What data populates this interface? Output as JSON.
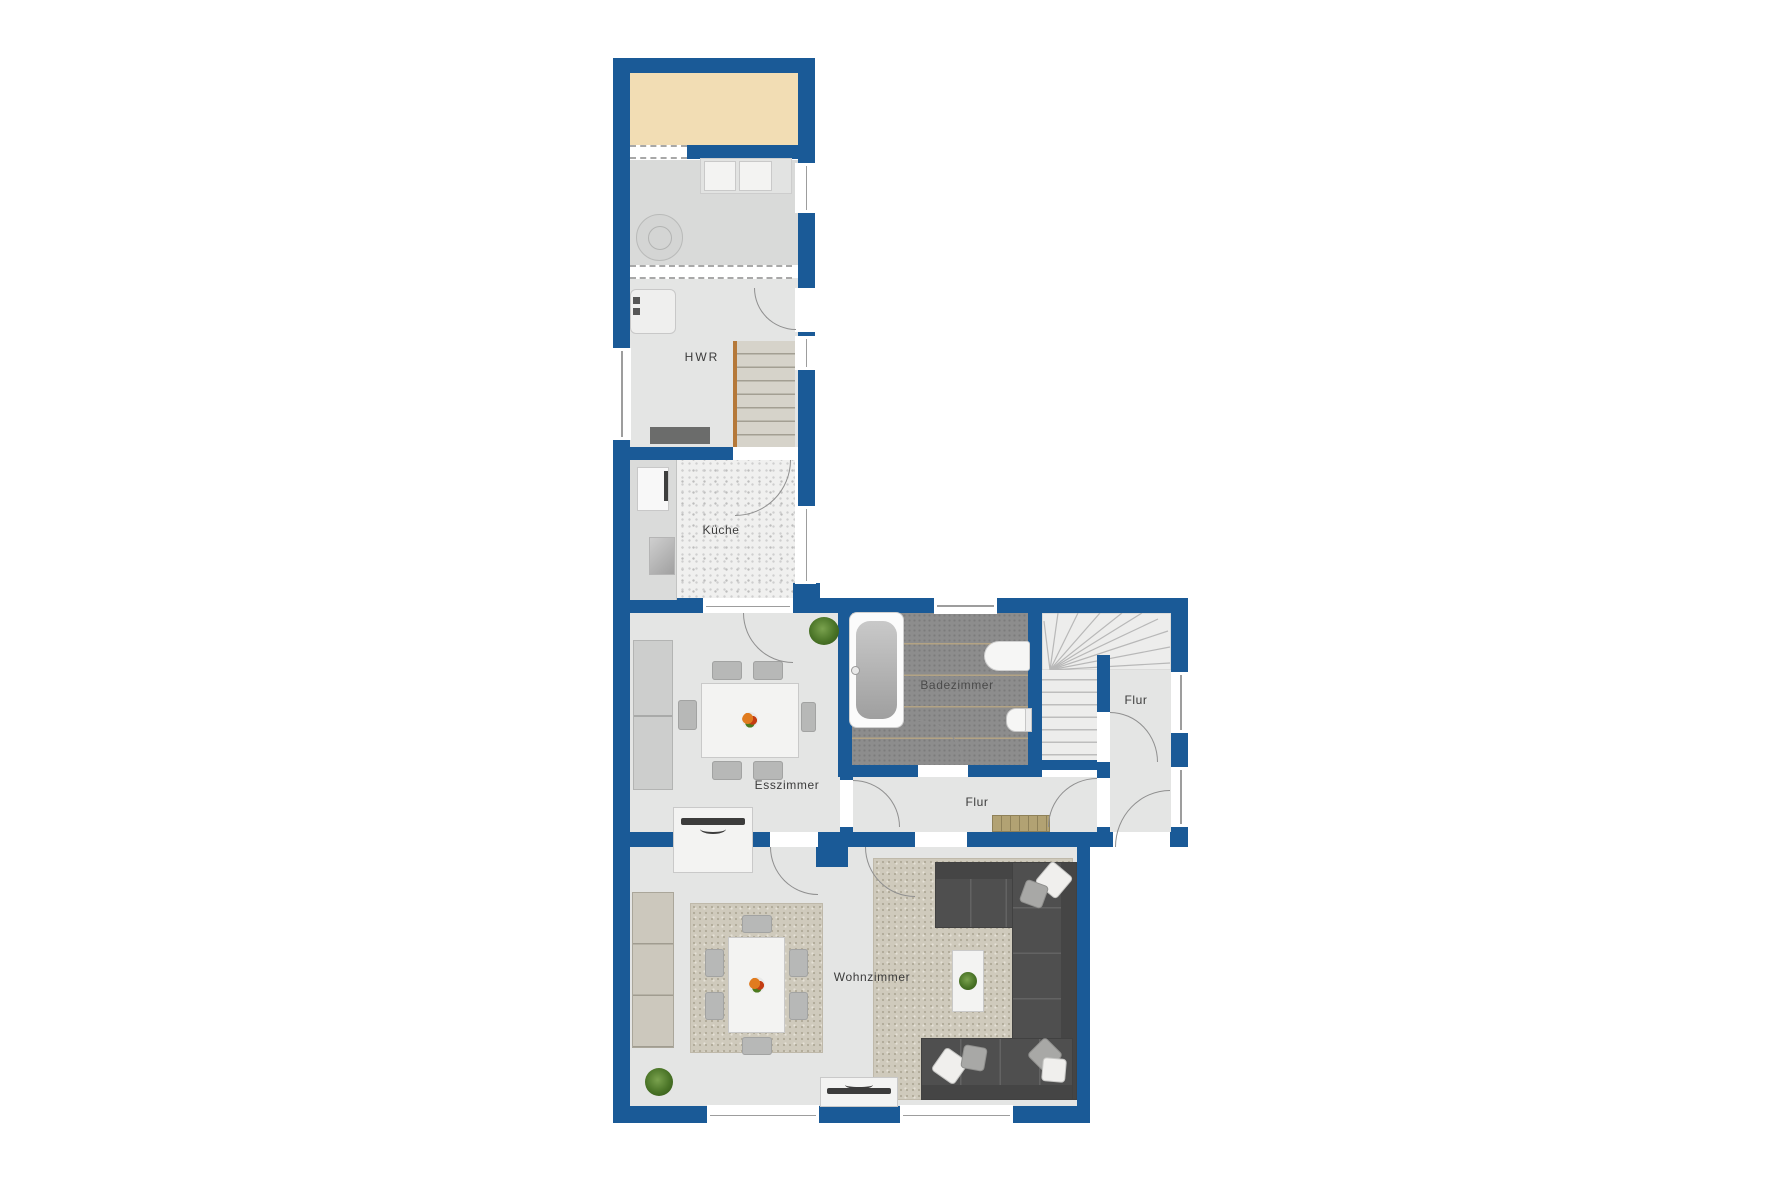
{
  "colors": {
    "wall_blue": "#1a5a97",
    "terrace_tan": "#f2ddb4",
    "bath_tile_gray": "#8d8d8d",
    "floor_gray": "#e4e5e4"
  },
  "rooms": [
    {
      "id": "hwr",
      "label": "HWR"
    },
    {
      "id": "kueche",
      "label": "Küche"
    },
    {
      "id": "esszimmer",
      "label": "Esszimmer"
    },
    {
      "id": "badezimmer",
      "label": "Badezimmer"
    },
    {
      "id": "flur_upper",
      "label": "Flur"
    },
    {
      "id": "flur_lower",
      "label": "Flur"
    },
    {
      "id": "wohnzimmer",
      "label": "Wohnzimmer"
    }
  ]
}
